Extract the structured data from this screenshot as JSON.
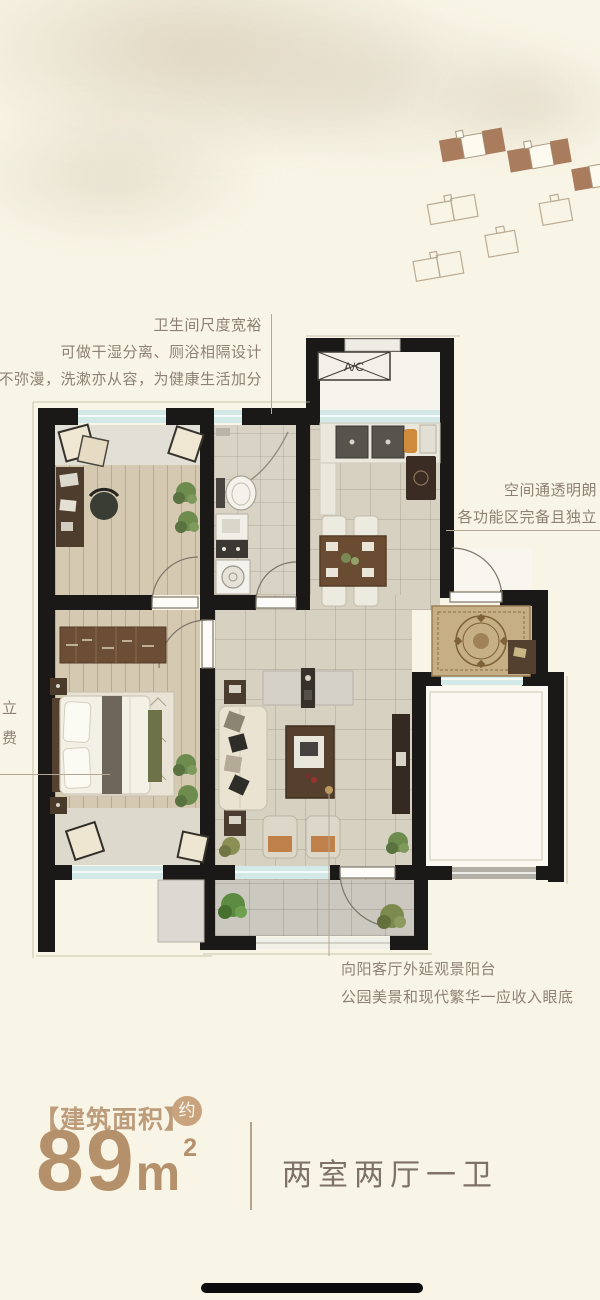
{
  "plan": {
    "ac_label": "A/C"
  },
  "annotations": {
    "top": {
      "lines": [
        "卫生间尺度宽裕",
        "可做干湿分离、厕浴相隔设计",
        "水汽不弥漫，洗漱亦从容，为健康生活加分"
      ]
    },
    "right": {
      "lines": [
        "空间通透明朗",
        "各功能区完备且独立"
      ]
    },
    "left": {
      "lines": [
        "立",
        "费"
      ]
    },
    "bottom": {
      "lines": [
        "向阳客厅外延观景阳台",
        "公园美景和现代繁华一应收入眼底"
      ]
    }
  },
  "area_section": {
    "bracket_label": "【建筑面积】",
    "approx_badge": "约",
    "area_number": "89",
    "area_unit": "m",
    "area_superscript": "2",
    "layout_label": "两室两厅一卫"
  },
  "colors": {
    "background": "#f9f5e6",
    "wall": "#1b1917",
    "accent_brown": "#b5916b",
    "annotation_text": "#8d8173",
    "serif_text": "#7d7265",
    "window_glass": "#d2e9e8",
    "leader_line": "#b3a795",
    "badge_bg": "#c9a37e",
    "home_indicator": "#0b0b0b"
  }
}
